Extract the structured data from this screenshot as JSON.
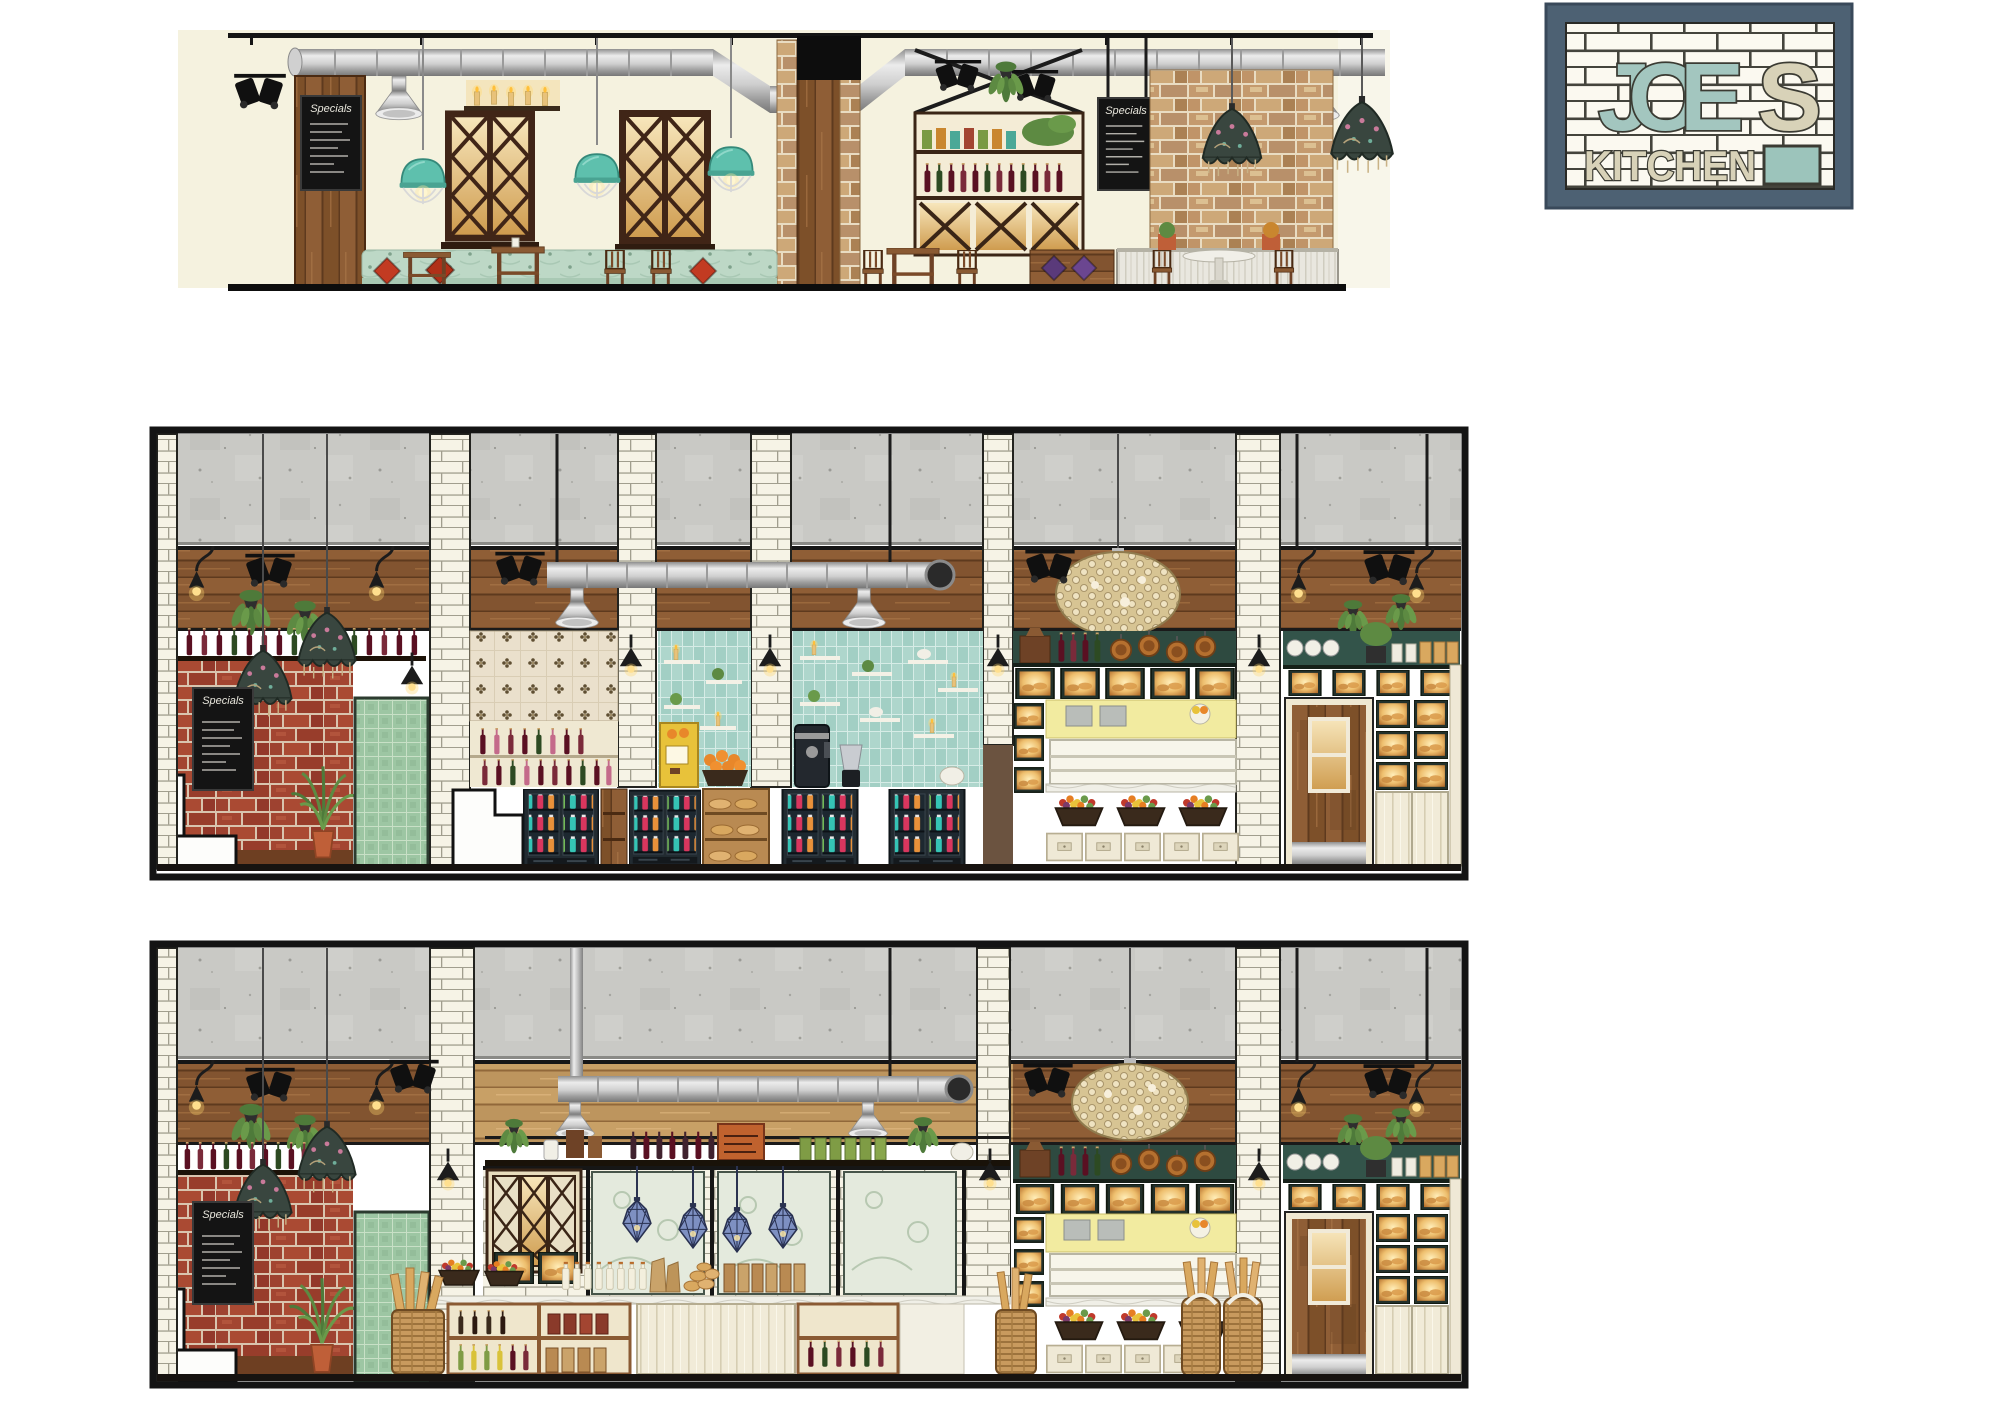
{
  "page": {
    "background_color": "#ffffff",
    "board_type": "restaurant interior design elevation presentation board"
  },
  "logo": {
    "name_line1_primary": "JOE",
    "name_line1_secondary": "S",
    "name_line2": "KITCHEN",
    "frame_color": "#4d6173",
    "tile_background": "#fbf9f0",
    "letter_teal": "#a3c6bf",
    "letter_cream": "#d8d2b8",
    "accent_block": "#9cc4bb"
  },
  "panels": [
    {
      "id": "top-elevation",
      "label": "Dining room elevation",
      "chalkboard_title": "Specials",
      "features": [
        "black ceiling track with theatre spotlights",
        "galvanised ventilation duct with bell vents",
        "turquoise caged pendant lights",
        "victorian fringed pendant shades",
        "timber column with specials chalkboard",
        "lattice glazed windows with warm light",
        "candle shelf",
        "pantry shelving with jars, wine bottles and lattice wine rack",
        "hanging chalkboard",
        "exposed brick chimney wall",
        "mint tufted banquette with red cushions",
        "timber cafe tables and chairs",
        "white-washed plank counter with pedestal table"
      ]
    },
    {
      "id": "middle-elevation",
      "label": "Servery and drinks counter elevation",
      "chalkboard_title": "Specials",
      "features": [
        "polished concrete upper wall",
        "timber plank band with black rail",
        "black cone wall lights and spotlights",
        "hanging ferns",
        "crystal chandelier",
        "white subway tile pilasters",
        "exposed red brick wall with chalkboard",
        "white booth seat",
        "potted palm",
        "green tiled door",
        "floral print wallpaper bay",
        "wine bottle display",
        "aqua tiled bays with floating shelves",
        "orange juice press and fruit",
        "coffee urn and blender",
        "glass-door drink fridges",
        "bread shelf with baguettes",
        "warm-lit bread display boxes",
        "yellow service counter with produce baskets",
        "cream drawer units",
        "timber kitchen door with glazed panel",
        "back-lit glass cabinets"
      ]
    },
    {
      "id": "bottom-elevation",
      "label": "Retail and deli counter elevation",
      "chalkboard_title": "Specials",
      "features": [
        "polished concrete upper wall",
        "light timber band with black display shelf",
        "galvanised duct with bell vents",
        "black cone wall lights and spotlights",
        "crystal chandelier",
        "blue faceted pendant lights",
        "etched floral glass partition",
        "lattice glazed cabinet",
        "deli counter with oils, preserves and juices",
        "fruit baskets and paper bags",
        "wicker baguette baskets",
        "yellow service counter",
        "cream drawer units",
        "timber kitchen door with glazed panel",
        "back-lit glass cabinets",
        "green tiled door",
        "exposed red brick wall with chalkboard",
        "white booth seat",
        "potted palm"
      ]
    }
  ],
  "palette": {
    "cream_wall": "#f5f2df",
    "concrete": "#c9c9c5",
    "wood_dark": "#8a5a33",
    "wood_light": "#c39a63",
    "brick_red": "#a34531",
    "brick_tan": "#c49a6e",
    "subway_tile": "#f6f3e6",
    "aqua_tile": "#aed6cc",
    "mint_banquette": "#bdd8c6",
    "teal_pendant": "#5ec0ad",
    "blue_pendant": "#7e90c2",
    "duct_silver": "#cfcfcf",
    "glow_amber": "#eebf6e",
    "counter_yellow": "#f2eba0",
    "pillow_red": "#c23b22",
    "pillow_purple": "#5a3a7a",
    "door_green_tile": "#9dc6a3"
  }
}
